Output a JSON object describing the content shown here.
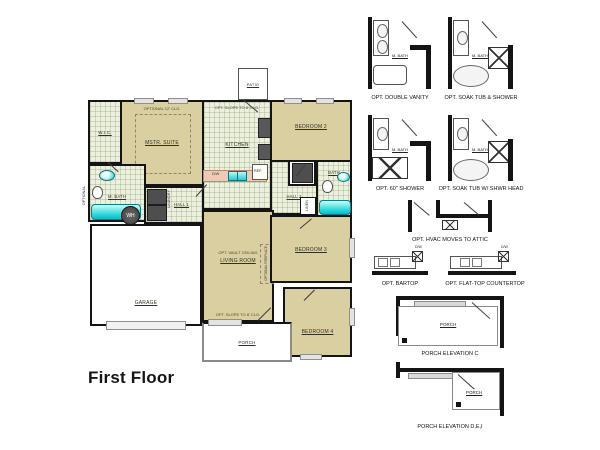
{
  "title": "First Floor",
  "floor_plan": {
    "patio": "PATIO",
    "wic": "W.I.C.",
    "master_suite": "MSTR. SUITE",
    "master_suite_option": "OPTIONAL 12' CLG.",
    "kitchen": "KITCHEN",
    "kitchen_option": "OPT. SLOPE TO 8' CLG.",
    "kitchen_ref": "REF",
    "kitchen_dw": "D/W",
    "bedroom_2": "BEDROOM 2",
    "master_bath": "M. BATH",
    "optional_door": "OPTIONAL",
    "laundry": "LAUNDRY",
    "hall_1": "HALL 1",
    "water_heater": "WH",
    "hall_2": "HALL 2",
    "bath": "BATH",
    "linen": "LINEN",
    "living_room": "LIVING ROOM",
    "living_room_option": "OPT. VAULT CEILING",
    "fireplace_option": "OPTIONAL FIREPLACE",
    "porch_option": "OPT. SLOPE TO 8' CLG.",
    "bedroom_3": "BEDROOM 3",
    "bedroom_4": "BEDROOM 4",
    "garage": "GARAGE",
    "porch": "PORCH"
  },
  "options_panel": {
    "bath_options": [
      {
        "label": "OPT. DOUBLE VANITY",
        "room": "M. BATH"
      },
      {
        "label": "OPT. SOAK TUB & SHOWER",
        "room": "M. BATH"
      },
      {
        "label": "OPT. 60\" SHOWER",
        "room": "M. BATH"
      },
      {
        "label": "OPT. SOAK TUB W/ SHWR HEAD",
        "room": "M. BATH"
      }
    ],
    "hvac_option": {
      "label": "OPT. HVAC MOVES TO ATTIC"
    },
    "kitchen_options": [
      {
        "label": "OPT. BARTOP",
        "appliance": "D/W"
      },
      {
        "label": "OPT. FLAT-TOP COUNTERTOP",
        "appliance": "D/W"
      }
    ],
    "porch_elevations": [
      {
        "label": "PORCH ELEVATION C",
        "room": "PORCH"
      },
      {
        "label": "PORCH ELEVATION D,E,I",
        "room": "PORCH"
      }
    ]
  },
  "colors": {
    "room_fill": "#d9cfa0",
    "tile_fill": "#edf0de",
    "wall": "#141414",
    "fixture_cyan": "#27d6da",
    "counter_salmon": "#eec9b4",
    "appliance_gray": "#4e4e4e"
  }
}
